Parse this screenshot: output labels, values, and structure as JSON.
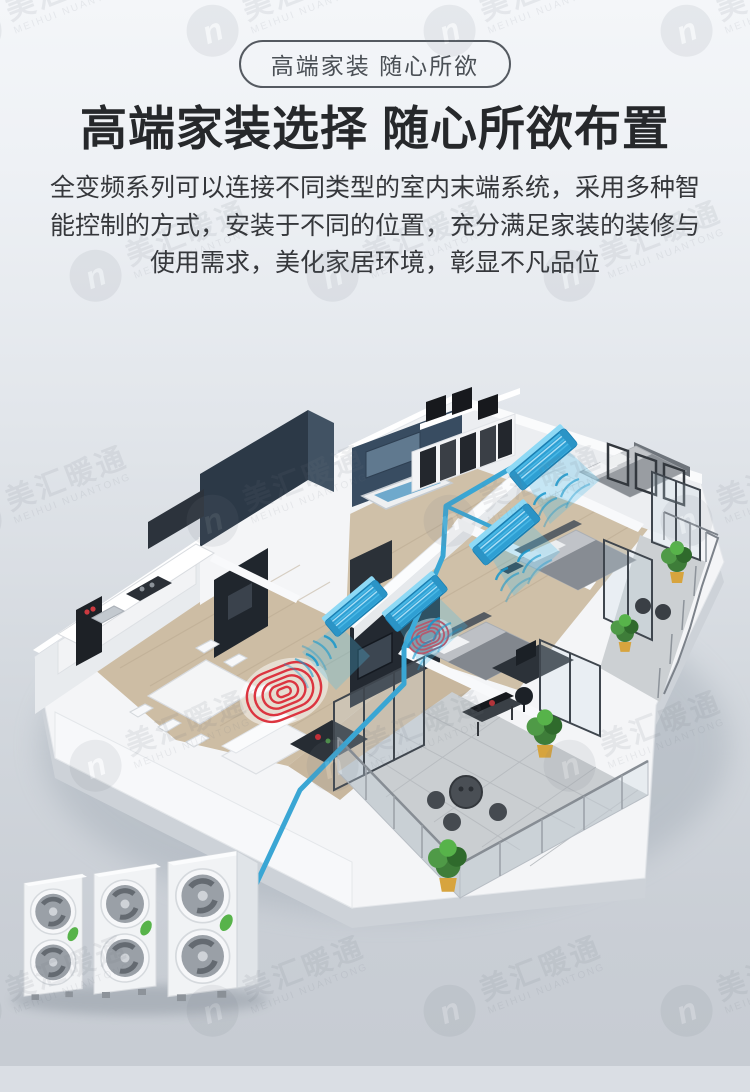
{
  "header": {
    "badge_label": "高端家装 随心所欲",
    "title": "高端家装选择 随心所欲布置",
    "description": "全变频系列可以连接不同类型的室内末端系统，采用多种智能控制的方式，安装于不同的位置，充分满足家装的装修与使用需求，美化家居环境，彰显不凡品位"
  },
  "watermark": {
    "brand": "美汇暖通",
    "brand_latin": "MEIHUI NUANTONG",
    "logo_letter": "n"
  },
  "scene": {
    "type": "isometric-apartment-floorplan",
    "indoor_unit_count": 4,
    "outdoor_unit_count": 3,
    "floor_heating_zones": 2,
    "colors": {
      "indoor_unit_blue": "#47b7e5",
      "airflow_teal": "#1697cd",
      "pipe_blue": "#3aa6d4",
      "heating_coil_red": "#dc3540",
      "leaf_green": "#57b34a",
      "wood_floor": "#cdbda4",
      "slate_wall": "#2c3947",
      "terrace_tile": "#caced1",
      "background_top": "#f4f6f9",
      "background_bottom": "#c7ccd3"
    }
  }
}
